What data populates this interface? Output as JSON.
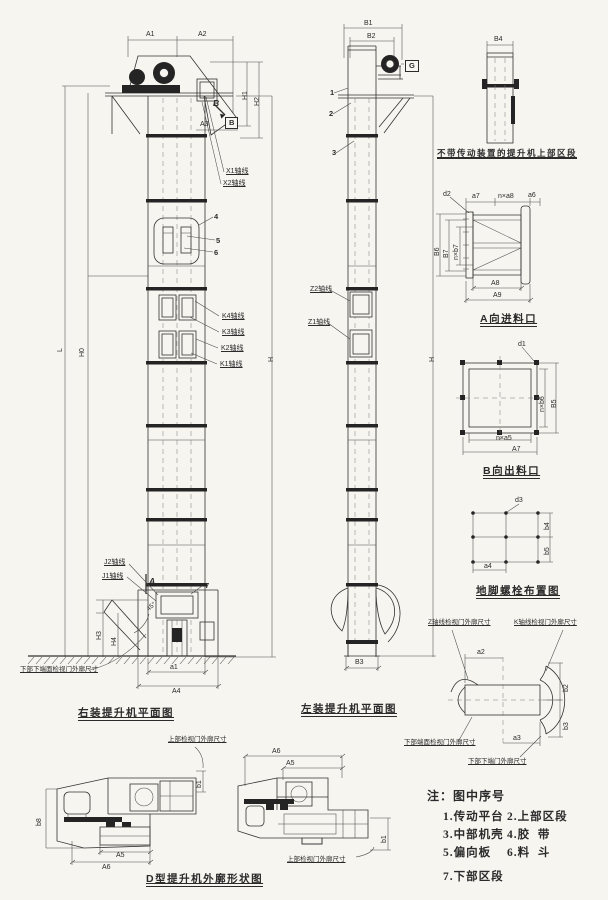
{
  "colors": {
    "ink": "#2b2b2b",
    "paper": "#f6f5f0"
  },
  "views": {
    "right_mount": {
      "caption": "右装提升机平面图",
      "dims": {
        "A1": "A1",
        "A2": "A2",
        "H1": "H1",
        "H2": "H2",
        "A3": "A3",
        "L": "L",
        "H0": "H0",
        "H": "H",
        "H3": "H3",
        "H4": "H4",
        "a1": "a1",
        "A4": "A4",
        "angle": "45°"
      },
      "markers": {
        "B_cut": "B",
        "B_box": "B",
        "A_sec": "A"
      },
      "callouts": {
        "X1": "X1轴线",
        "X2": "X2轴线",
        "n4": "4",
        "n5": "5",
        "n6": "6",
        "n7": "7",
        "K4": "K4轴线",
        "K3": "K3轴线",
        "K2": "K2轴线",
        "K1": "K1轴线",
        "J2": "J2轴线",
        "J1": "J1轴线"
      },
      "note_door": "下部下端面检视门外廓尺寸"
    },
    "left_mount": {
      "caption": "左装提升机平面图",
      "dims": {
        "B1": "B1",
        "B2": "B2",
        "H": "H",
        "B3": "B3"
      },
      "markers": {
        "G": "G"
      },
      "callouts": {
        "n1": "1",
        "n2": "2",
        "n3": "3",
        "Z2": "Z2轴线",
        "Z1": "Z1轴线"
      }
    },
    "upper_no_drive": {
      "caption": "不带传动装置的提升机上部区段",
      "dims": {
        "B4": "B4"
      }
    },
    "inlet": {
      "caption": "A向进料口",
      "dims": {
        "d2": "d2",
        "a7": "a7",
        "na8": "n×a8",
        "a6": "a6",
        "B6": "B6",
        "B7": "B7",
        "nb7": "n×b7",
        "A8": "A8",
        "A9": "A9"
      }
    },
    "outlet": {
      "caption": "B向出料口",
      "dims": {
        "d1": "d1",
        "nb6": "n×b6",
        "B5": "B5",
        "na5": "n×a5",
        "A7": "A7"
      }
    },
    "anchor": {
      "caption": "地脚螺栓布置图",
      "dims": {
        "d3": "d3",
        "b4": "b4",
        "b5": "b5",
        "a4": "a4"
      }
    },
    "door_detail": {
      "labels": {
        "tl": "Z轴线检视门外廓尺寸",
        "tr": "K轴线检视门外廓尺寸",
        "bl": "下部端面检视门外廓尺寸",
        "br": "下部下端门外廓尺寸"
      },
      "dims": {
        "a2": "a2",
        "a3": "a3",
        "b2": "b2",
        "b3": "b3"
      }
    },
    "outline_d": {
      "caption": "D型提升机外廓形状图",
      "door_label": "上部检视门外廓尺寸",
      "dims": {
        "b8": "b8",
        "A5": "A5",
        "A6": "A6",
        "b1": "b1"
      }
    }
  },
  "notes": {
    "title": "注：图中序号",
    "items": [
      [
        "1.传动平台",
        "2.上部区段"
      ],
      [
        "3.中部机壳",
        "4.胶  带"
      ],
      [
        "5.偏向板",
        "6.料  斗"
      ],
      [
        "7.下部区段",
        ""
      ]
    ]
  }
}
